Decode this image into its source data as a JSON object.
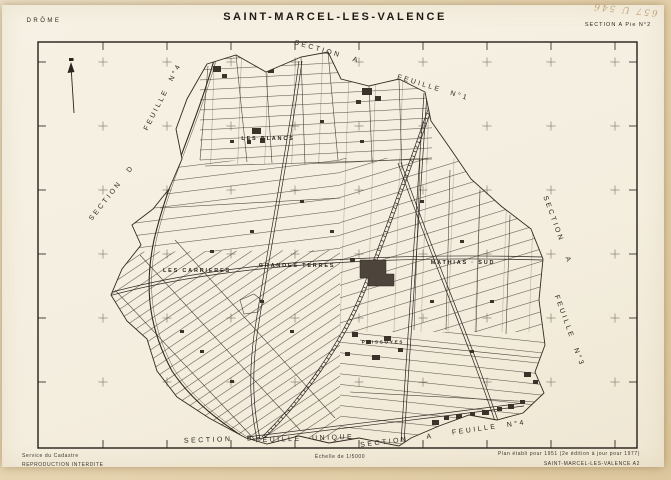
{
  "colors": {
    "mat": "#e6d3ae",
    "sheet": "#f5f0e2",
    "ink": "#2b2520",
    "pencil_note": "#bd9b66"
  },
  "header": {
    "department": "DRÔME",
    "title": "SAINT-MARCEL-LES-VALENCE",
    "sheet_ref": "SECTION A Pie N°2",
    "handwritten_note": "657 U 546"
  },
  "map": {
    "scale_denominator": "1/5000",
    "section_a_top": "SECTION A",
    "feuille_n1": "FEUILLE N°1",
    "feuille_n4_left": "FEUILLE N°4",
    "section_d": "SECTION D",
    "section_a_right": "SECTION A",
    "feuille_n3": "FEUILLE N°3",
    "feuille_n4_bottom": "FEUILLE N°4",
    "section_a_bottom": "SECTION A",
    "section_b": "SECTION B",
    "feuille_unique": "FEUILLE UNIQUE",
    "lieu_dits": {
      "les_blancs": "LES BLANCS",
      "les_carrieres": "LES CARRIERES",
      "grandes_terres": "GRANDES TERRES",
      "mathias_sud": "MATHIAS · SUD",
      "poissoyes": "POISSOYES"
    }
  },
  "footer": {
    "issuer_line1": "Service du Cadastre",
    "issuer_line2": "REPRODUCTION INTERDITE",
    "scale": "Échelle de 1/5000",
    "edition": "Plan établi pour 1951 (2e édition à jour pour 1977)",
    "sheet_id": "SAINT-MARCEL-LES-VALENCE  A2"
  }
}
